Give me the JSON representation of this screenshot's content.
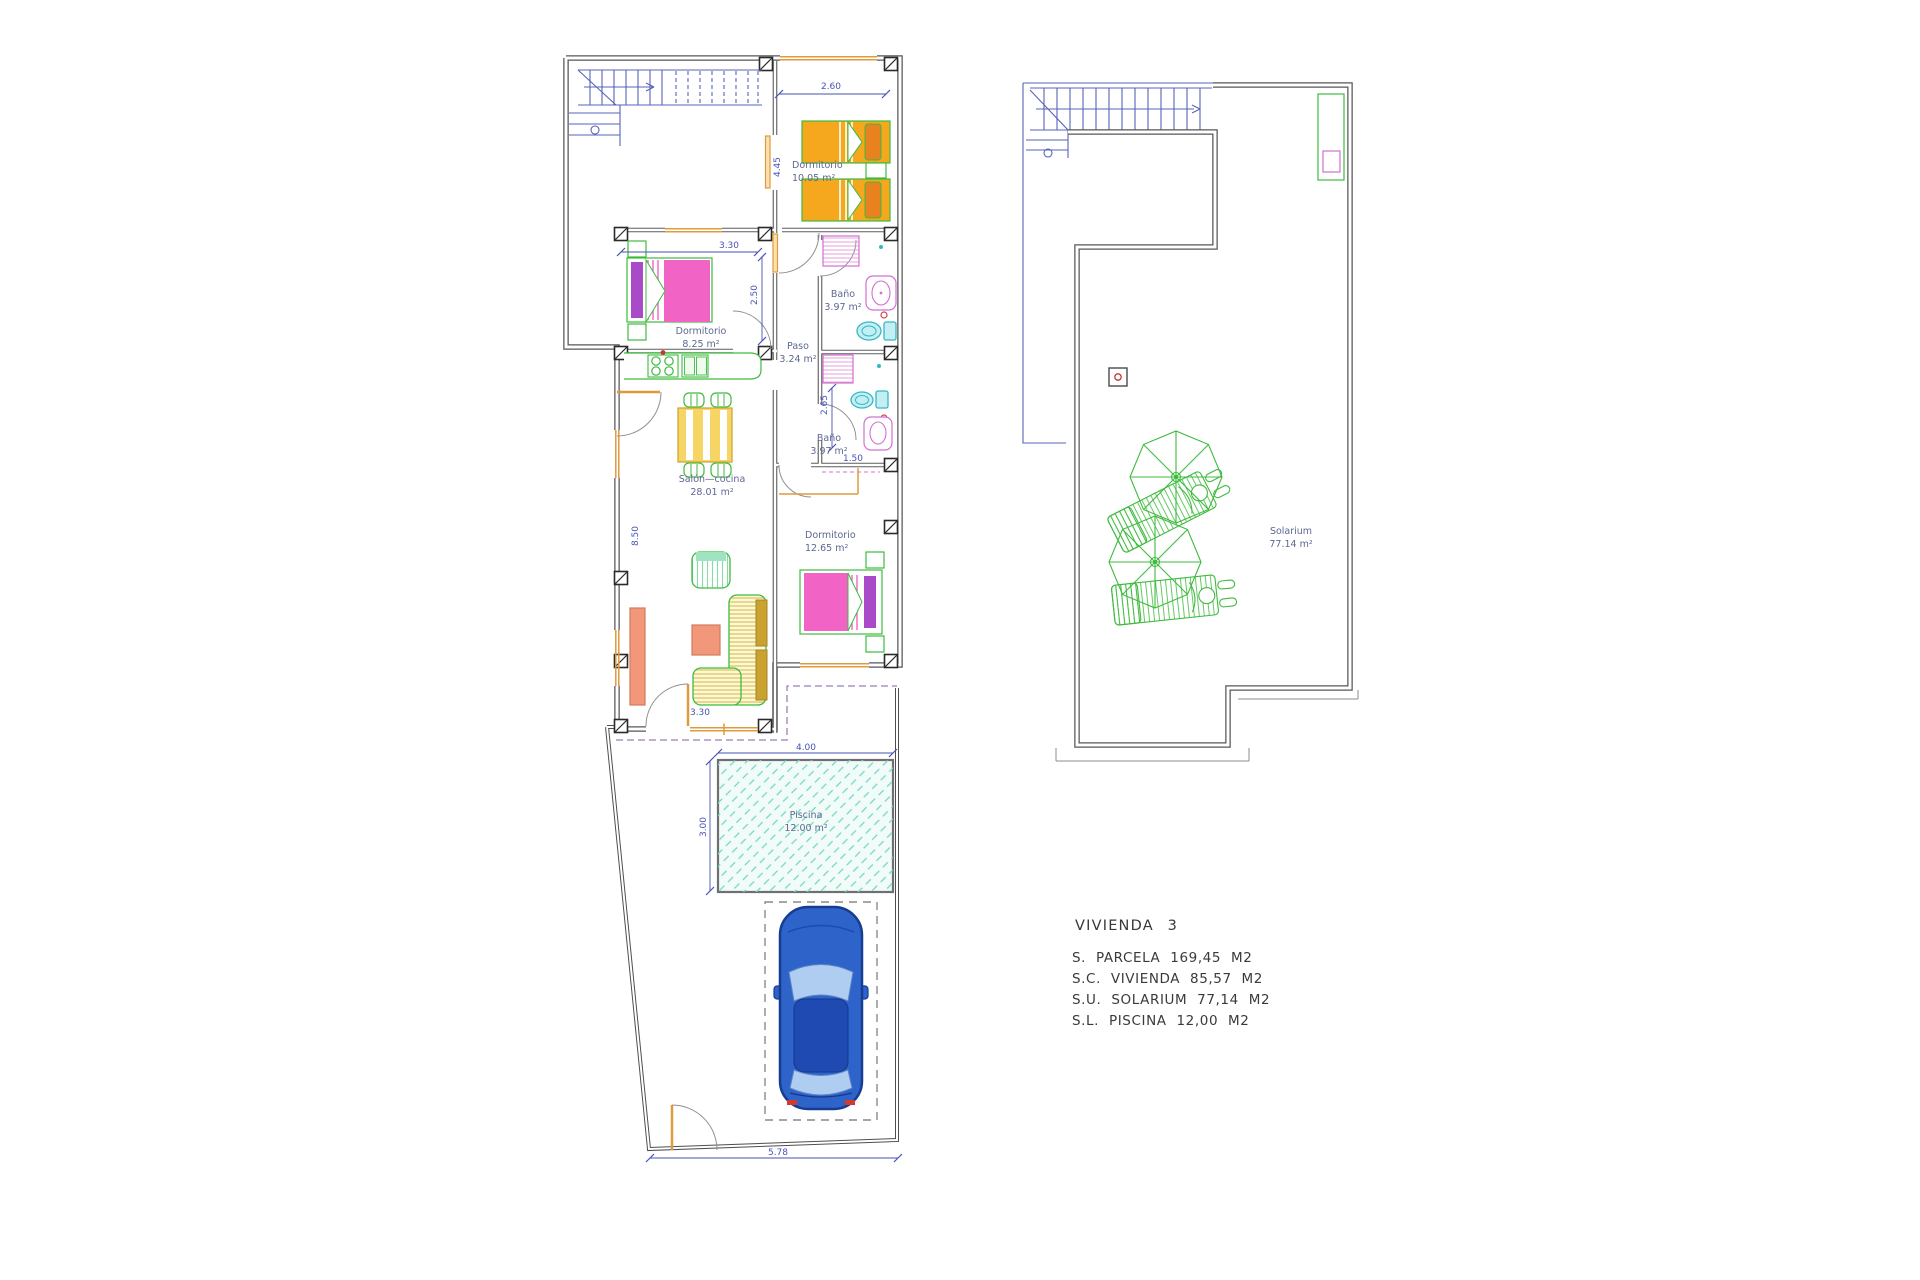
{
  "ground_floor": {
    "rooms": {
      "dorm1": {
        "name": "Dormitorio",
        "area": "10.05 m²"
      },
      "dorm2": {
        "name": "Dormitorio",
        "area": "8.25 m²"
      },
      "bath1": {
        "name": "Baño",
        "area": "3.97 m²"
      },
      "paso": {
        "name": "Paso",
        "area": "3.24 m²"
      },
      "bath2": {
        "name": "Baño",
        "area": "3.97 m²"
      },
      "salon": {
        "name": "Salón—cocina",
        "area": "28.01 m²"
      },
      "dorm3": {
        "name": "Dormitorio",
        "area": "12.65 m²"
      },
      "piscina": {
        "name": "Piscina",
        "area": "12.00 m²"
      }
    },
    "dimensions": {
      "dorm1_width": "2.60",
      "dorm1_height": "4.45",
      "dorm2_width": "3.30",
      "dorm2_height": "2.50",
      "bath2_height": "2.65",
      "bath2_width": "1.50",
      "salon_height": "8.50",
      "salon_entry_width": "3.30",
      "pool_width": "4.00",
      "pool_height": "3.00",
      "plot_bottom_width": "5.78"
    }
  },
  "roof_floor": {
    "rooms": {
      "solarium": {
        "name": "Solarium",
        "area": "77.14 m²"
      }
    }
  },
  "legend": {
    "title": "VIVIENDA 3",
    "lines": [
      "S. PARCELA 169,45 M2",
      "S.C. VIVIENDA 85,57 M2",
      "S.U. SOLARIUM 77,14 M2",
      "S.L. PISCINA 12,00 M2"
    ]
  },
  "colors": {
    "wall": "#575757",
    "cad_blue": "#5663b8",
    "dimension_blue": "#4752b5",
    "room_label": "#5d6890",
    "furniture_green": "#3dbb3d",
    "bed_orange": "#f5a81e",
    "pillow_orange": "#e8821e",
    "bed_pink": "#f263c6",
    "pillow_purple": "#a94bc9",
    "bath_magenta": "#d36fd3",
    "toilet_cyan": "#35b8c4",
    "pool_teal": "#72d6c8",
    "table_salmon": "#f2977a",
    "table_yellow": "#f6d565",
    "cushion_mustard": "#c9a232",
    "car_blue": "#2e63c9",
    "door_orange": "#e09a3e",
    "parcel_dash_purple": "#9b7fb5",
    "legend_text": "#3a3a3a"
  }
}
